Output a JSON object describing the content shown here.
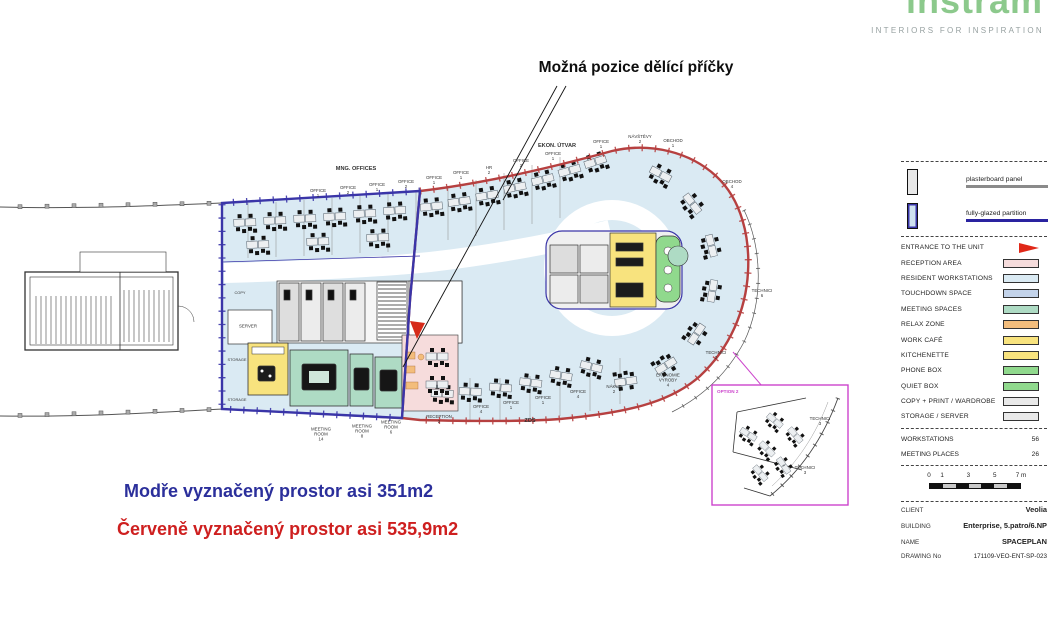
{
  "logo": {
    "brand": "instram",
    "tagline": "INTERIORS FOR INSPIRATION",
    "brand_color": "#8cc98c"
  },
  "annotation": {
    "heading": "Možná pozice dělící příčky"
  },
  "notes": {
    "blue": {
      "text": "Modře vyznačený prostor asi 351m2",
      "color": "#2b2f9b"
    },
    "red": {
      "text": "Červeně vyznačený prostor asi 535,9m2",
      "color": "#ce1f1f"
    }
  },
  "plan": {
    "boundary_colors": {
      "blue": "#3a35a8",
      "red": "#b64040"
    },
    "area_labels": [
      {
        "t": "MNG. OFFICES",
        "x": 356,
        "y": 169,
        "s": 5.6,
        "b": 1
      },
      {
        "t": "EKON. ÚTVAR",
        "x": 557,
        "y": 146,
        "s": 5.6,
        "b": 1
      },
      {
        "t": "OFFICE\n1",
        "x": 318,
        "y": 193,
        "s": 4.4
      },
      {
        "t": "OFFICE\n2",
        "x": 348,
        "y": 190,
        "s": 4.4
      },
      {
        "t": "OFFICE\n1",
        "x": 377,
        "y": 187,
        "s": 4.4
      },
      {
        "t": "OFFICE\n2",
        "x": 406,
        "y": 184,
        "s": 4.4
      },
      {
        "t": "OFFICE\n1",
        "x": 434,
        "y": 180,
        "s": 4.4
      },
      {
        "t": "OFFICE\n1",
        "x": 461,
        "y": 175,
        "s": 4.4
      },
      {
        "t": "HR\n2",
        "x": 489,
        "y": 170,
        "s": 4.4
      },
      {
        "t": "OFFICE\n2",
        "x": 521,
        "y": 163,
        "s": 4.4
      },
      {
        "t": "OFFICE\n1",
        "x": 553,
        "y": 156,
        "s": 4.4
      },
      {
        "t": "OFFICE\n1",
        "x": 601,
        "y": 144,
        "s": 4.4
      },
      {
        "t": "NÁVŠTĚVY\n2",
        "x": 640,
        "y": 139,
        "s": 4.4
      },
      {
        "t": "OBCHOD\n1",
        "x": 673,
        "y": 143,
        "s": 4.4
      },
      {
        "t": "OBCHOD\n4",
        "x": 732,
        "y": 184,
        "s": 4.4
      },
      {
        "t": "TECHNICI\n6",
        "x": 762,
        "y": 293,
        "s": 4.4
      },
      {
        "t": "TECHNICI\n2",
        "x": 716,
        "y": 355,
        "s": 4.4
      },
      {
        "t": "EKONOMIE\nVÝROBY\n4",
        "x": 668,
        "y": 380,
        "s": 4.4
      },
      {
        "t": "NÁKUP\n2",
        "x": 614,
        "y": 389,
        "s": 4.4
      },
      {
        "t": "OFFICE\n4",
        "x": 578,
        "y": 394,
        "s": 4.4
      },
      {
        "t": "OFFICE\n1",
        "x": 543,
        "y": 400,
        "s": 4.4
      },
      {
        "t": "OFFICE\n1",
        "x": 511,
        "y": 405,
        "s": 4.4
      },
      {
        "t": "OFFICE\n4",
        "x": 481,
        "y": 409,
        "s": 4.4
      },
      {
        "t": "ZDS",
        "x": 530,
        "y": 421,
        "s": 5.6,
        "b": 1
      },
      {
        "t": "RECEPTION\n2",
        "x": 439,
        "y": 419,
        "s": 4.4
      },
      {
        "t": "MEETING\nROOM\n6",
        "x": 391,
        "y": 427,
        "s": 4.4
      },
      {
        "t": "MEETING\nROOM\n8",
        "x": 362,
        "y": 431,
        "s": 4.4
      },
      {
        "t": "MEETING\nROOM\n14",
        "x": 321,
        "y": 434,
        "s": 4.4
      },
      {
        "t": "SERVER",
        "x": 248,
        "y": 326,
        "s": 4.4
      },
      {
        "t": "STORAGE",
        "x": 237,
        "y": 360,
        "s": 3.9
      },
      {
        "t": "STORAGE",
        "x": 237,
        "y": 400,
        "s": 3.9
      },
      {
        "t": "COPY",
        "x": 240,
        "y": 293,
        "s": 3.9
      }
    ],
    "inset": {
      "title": "OPTION 2",
      "title_color": "#cc44cc",
      "labels": [
        {
          "t": "TECHNICI\n3",
          "x": 820,
          "y": 421,
          "s": 4.4
        },
        {
          "t": "TECHNICI\n3",
          "x": 805,
          "y": 470,
          "s": 4.4
        }
      ]
    }
  },
  "legend": {
    "partitions": [
      {
        "label": "plasterboard panel",
        "color": "#8a8a8a"
      },
      {
        "label": "fully-glazed partition",
        "color": "#2a23a0"
      }
    ],
    "entrance": {
      "label": "ENTRANCE TO THE UNIT",
      "icon_color": "#e02818"
    },
    "zones": [
      {
        "label": "RECEPTION AREA",
        "color": "#f6dcdc"
      },
      {
        "label": "RESIDENT WORKSTATIONS",
        "color": "#daeaf3"
      },
      {
        "label": "TOUCHDOWN SPACE",
        "color": "#c3d3ea"
      },
      {
        "label": "MEETING SPACES",
        "color": "#aedbc4"
      },
      {
        "label": "RELAX ZONE",
        "color": "#f3bd7c"
      },
      {
        "label": "WORK CAFÉ",
        "color": "#f8e37e"
      },
      {
        "label": "KITCHENETTE",
        "color": "#f8e37e"
      },
      {
        "label": "PHONE BOX",
        "color": "#90d98d"
      },
      {
        "label": "QUIET BOX",
        "color": "#90d98d"
      },
      {
        "label": "COPY + PRINT / WARDROBE",
        "color": "#e9e9e9"
      },
      {
        "label": "STORAGE / SERVER",
        "color": "#e9e9e9"
      }
    ],
    "stats": [
      {
        "label": "WORKSTATIONS",
        "value": "56"
      },
      {
        "label": "MEETING PLACES",
        "value": "26"
      }
    ],
    "scale": {
      "labels": [
        "0",
        "1",
        "3",
        "5",
        "7 m"
      ],
      "positions": [
        0,
        1,
        3,
        5,
        7
      ],
      "max": 7
    },
    "title_block": [
      {
        "label": "CLIENT",
        "value": "Veolia"
      },
      {
        "label": "BUILDING",
        "value": "Enterprise, 5.patro/6.NP"
      },
      {
        "label": "NAME",
        "value": "SPACEPLAN"
      },
      {
        "label": "DRAWING No",
        "value": "171109-VEO-ENT-SP-023",
        "small": 1
      }
    ]
  }
}
